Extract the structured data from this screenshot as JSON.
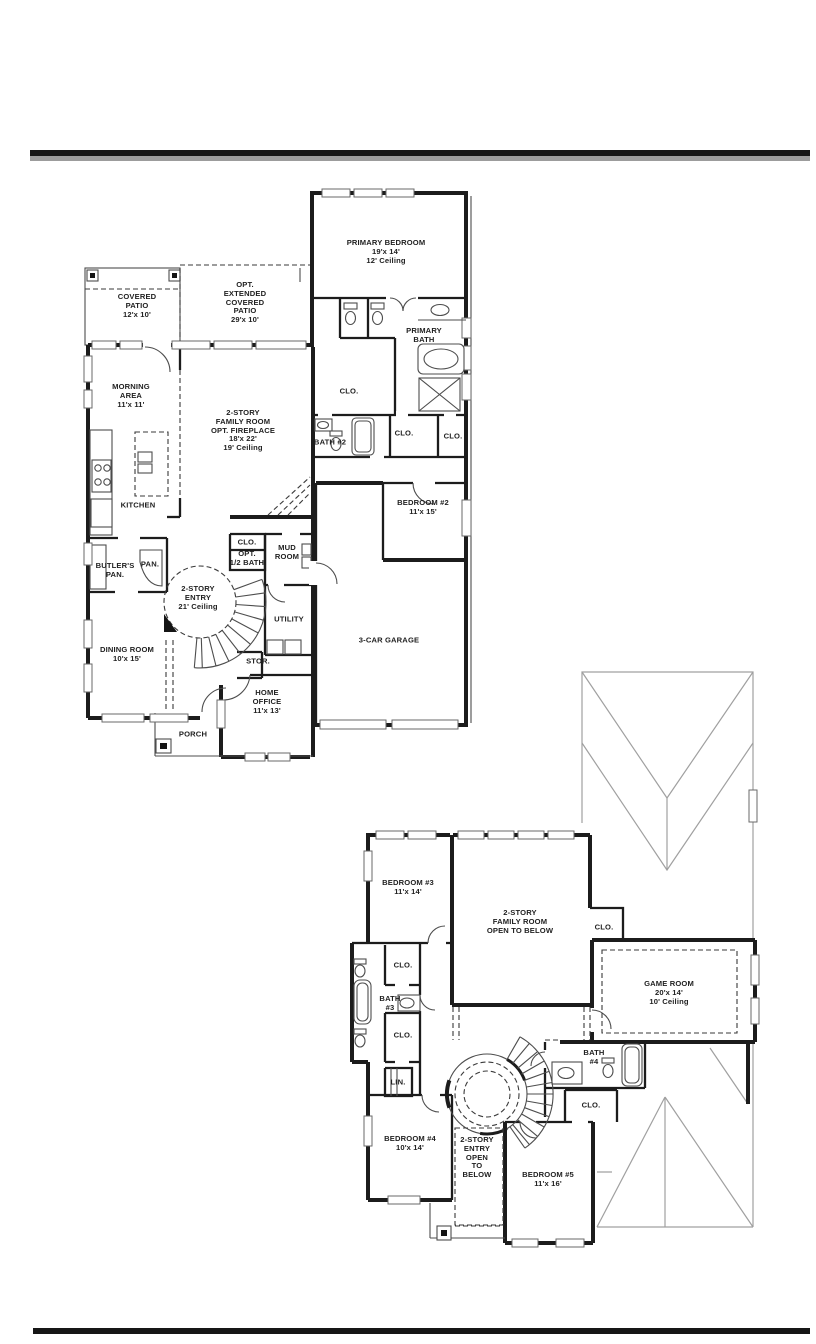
{
  "colors": {
    "wall": "#1c1c1c",
    "thin_line": "#4d4d4d",
    "roof_line": "#a0a0a0",
    "top_rule": "#161616",
    "top_rule_shadow": "#9c9c9c",
    "bottom_rule": "#161616",
    "background": "#ffffff"
  },
  "floor1": {
    "rooms": {
      "covered_patio": "COVERED\nPATIO\n12'x 10'",
      "ext_patio": "OPT.\nEXTENDED\nCOVERED\nPATIO\n29'x 10'",
      "primary_bedroom": "PRIMARY BEDROOM\n19'x 14'\n12' Ceiling",
      "primary_bath": "PRIMARY\nBATH",
      "primary_clo": "CLO.",
      "bath2": "BATH #2",
      "clo_a": "CLO.",
      "clo_b": "CLO.",
      "morning": "MORNING\nAREA\n11'x 11'",
      "family": "2-STORY\nFAMILY ROOM\nOPT. FIREPLACE\n18'x 22'\n19' Ceiling",
      "kitchen": "KITCHEN",
      "bedroom2": "BEDROOM #2\n11'x 15'",
      "butlers_pan": "BUTLER'S\nPAN.",
      "pan": "PAN.",
      "clo_hall": "CLO.",
      "opt_half_bath": "OPT.\n1/2 BATH",
      "mud": "MUD\nROOM",
      "entry": "2-STORY\nENTRY\n21' Ceiling",
      "utility": "UTILITY",
      "stor": "STOR.",
      "dining": "DINING ROOM\n10'x 15'",
      "garage": "3-CAR GARAGE",
      "office": "HOME\nOFFICE\n11'x 13'",
      "porch": "PORCH"
    }
  },
  "floor2": {
    "rooms": {
      "bedroom3": "BEDROOM #3\n11'x 14'",
      "family_open": "2-STORY\nFAMILY ROOM\nOPEN TO BELOW",
      "clo_family": "CLO.",
      "game": "GAME ROOM\n20'x 14'\n10' Ceiling",
      "clo_bath3_upper": "CLO.",
      "bath3": "BATH\n#3",
      "clo_bath3_lower": "CLO.",
      "lin": "LIN.",
      "bath4": "BATH\n#4",
      "clo_bedroom5": "CLO.",
      "bedroom4": "BEDROOM #4\n10'x 14'",
      "entry_open": "2-STORY\nENTRY\nOPEN\nTO\nBELOW",
      "bedroom5": "BEDROOM #5\n11'x 16'"
    }
  }
}
